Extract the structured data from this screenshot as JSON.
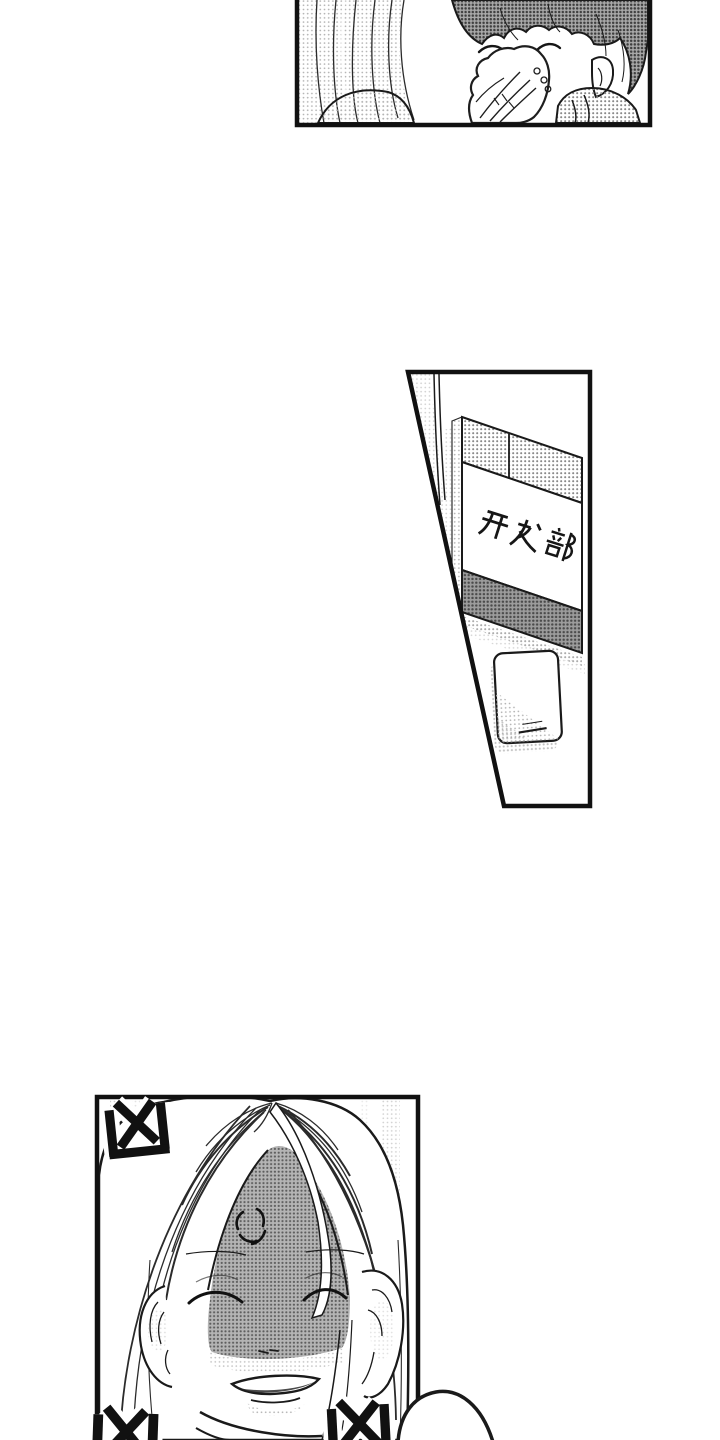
{
  "page": {
    "kind": "manga page",
    "paper_color": "#ffffff",
    "ink_color": "#1a1a1a",
    "tone_dot_color": "#8a8a8a"
  },
  "top_panel": {
    "description": "boy stifling a laugh behind his hand, next to a long-haired person seen from behind"
  },
  "middle_panel": {
    "description": "office door with name plate and light switch",
    "sign_text": "开发部"
  },
  "bottom_panel": {
    "description": "smiling character with shadowed face and anger vein mark",
    "rage_glyph": "凶",
    "rage_count": "3"
  }
}
